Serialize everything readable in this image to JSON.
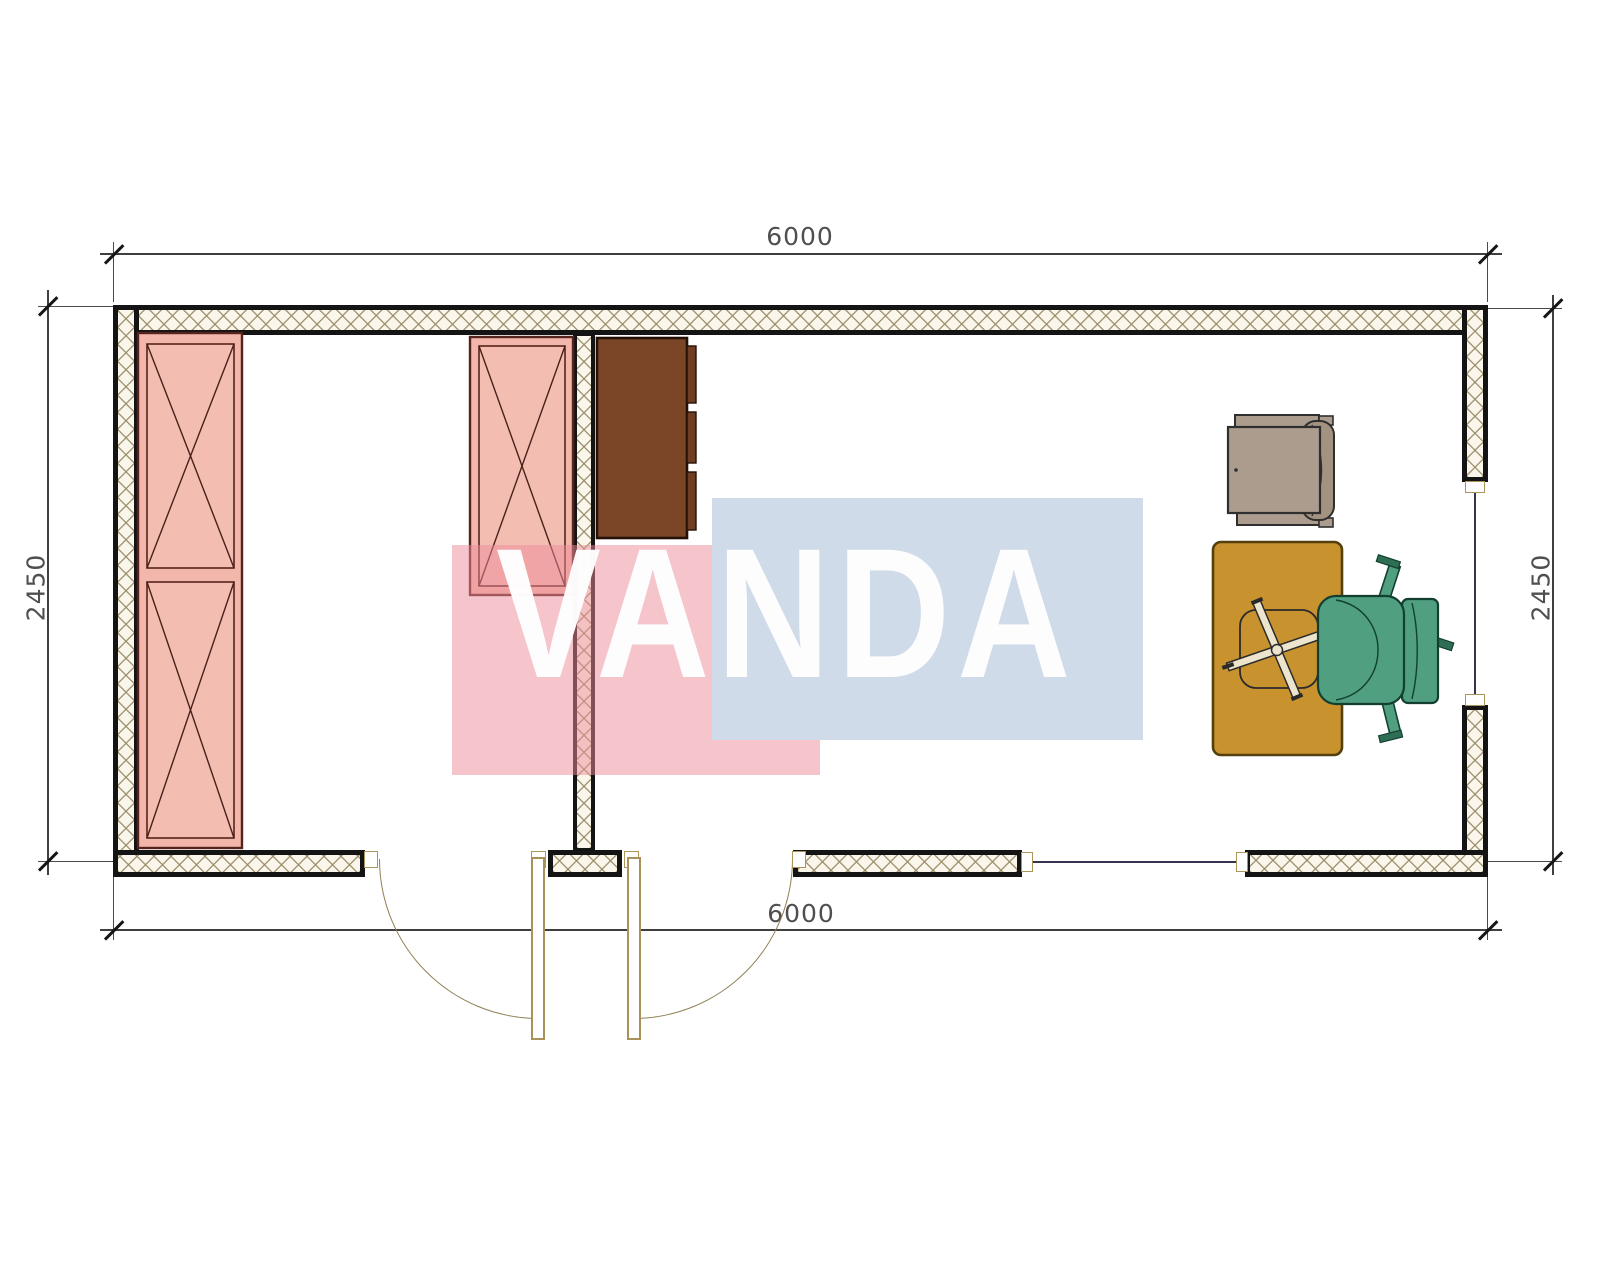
{
  "plan": {
    "title": "container-cabin-floor-plan",
    "dimensions": {
      "top_width": "6000",
      "bottom_width": "6000",
      "left_height": "2450",
      "right_height": "2450"
    },
    "watermark": {
      "text": "VANDA",
      "red_color": "#ee8c99",
      "blue_color": "#cfdbe8"
    },
    "furniture": [
      {
        "name": "double-wardrobe-left",
        "symbol": "crossed-rectangle"
      },
      {
        "name": "single-wardrobe-center",
        "symbol": "crossed-rectangle"
      },
      {
        "name": "brown-cabinet",
        "symbol": "filled-rectangle"
      },
      {
        "name": "armchair",
        "symbol": "chair-top-view"
      },
      {
        "name": "desk",
        "symbol": "table-top-view"
      },
      {
        "name": "office-chair",
        "symbol": "swivel-chair-top-view"
      }
    ],
    "openings": [
      {
        "name": "entrance-door-left",
        "type": "door",
        "swing": "outward"
      },
      {
        "name": "entrance-door-right",
        "type": "door",
        "swing": "outward"
      },
      {
        "name": "window-south",
        "type": "window"
      },
      {
        "name": "window-east",
        "type": "window"
      }
    ],
    "colors": {
      "wardrobe_pink": "#f2b6ab",
      "cabinet_brown": "#7b4628",
      "desk_tan": "#c8932e",
      "chair_green": "#4f9f80",
      "armchair_taupe": "#ab9c8e",
      "wall_hatch": "#968a64"
    }
  }
}
